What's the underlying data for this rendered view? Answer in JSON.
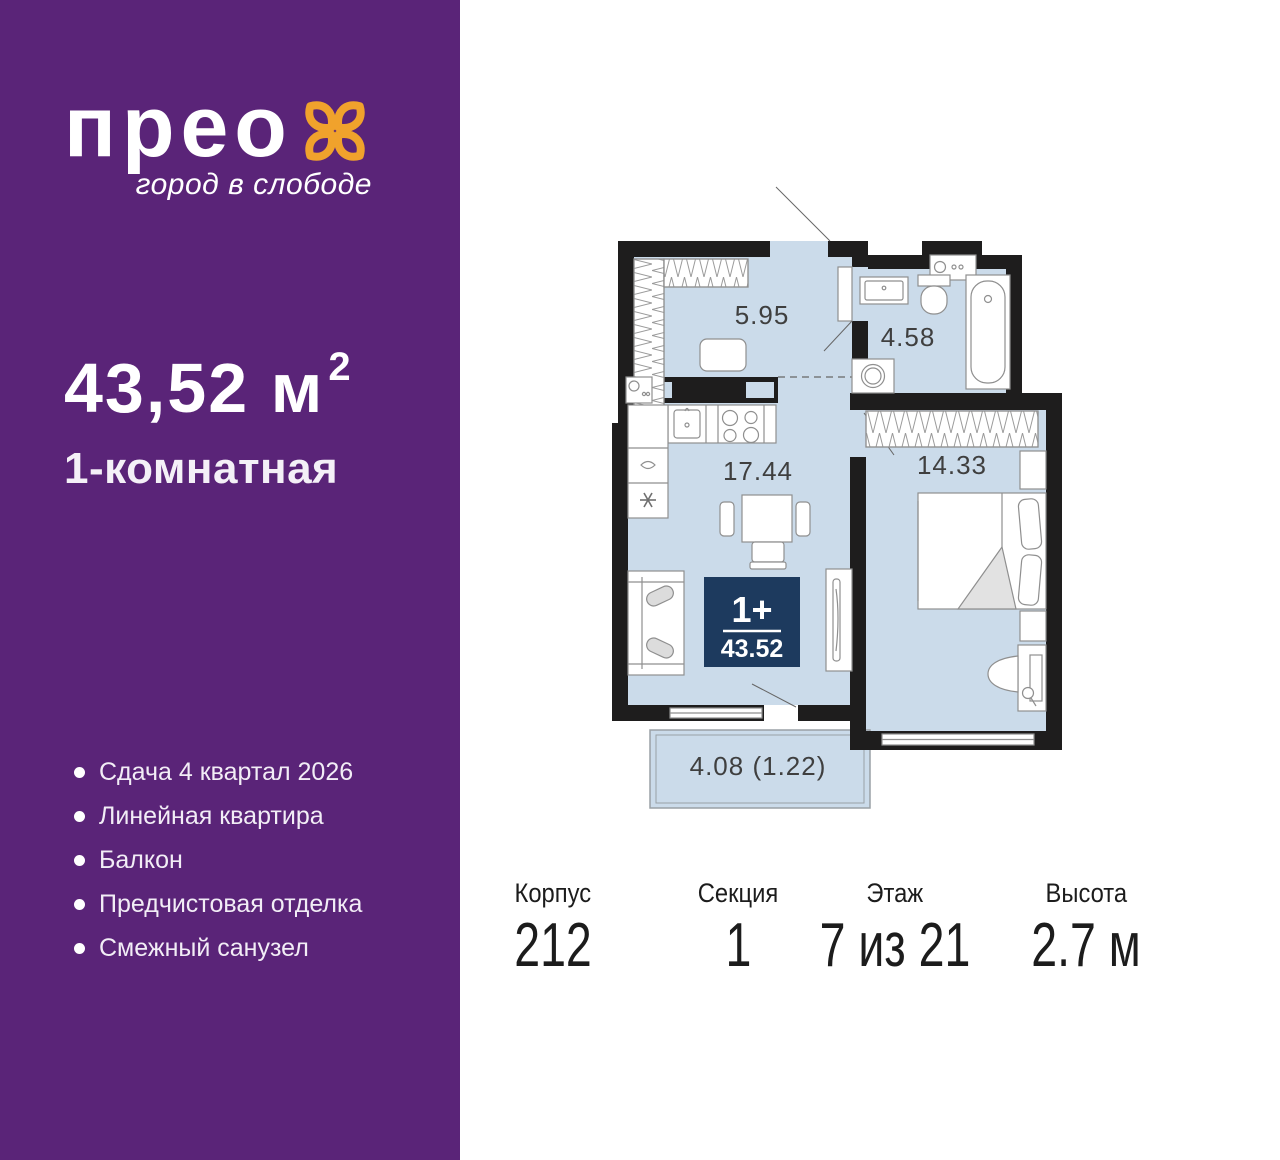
{
  "sidebar": {
    "logo_text": "прео",
    "logo_tagline": "город в слободе",
    "area_value": "43,52 м",
    "area_superscript": "2",
    "apartment_type": "1-комнатная",
    "features": [
      "Сдача 4 квартал 2026",
      "Линейная квартира",
      "Балкон",
      "Предчистовая отделка",
      "Смежный санузел"
    ],
    "colors": {
      "background": "#5a2478",
      "logo_accent": "#f0a22c"
    }
  },
  "floorplan": {
    "fill_color": "#cbdbea",
    "wall_color": "#1e1d1d",
    "rooms": [
      {
        "name": "hallway",
        "area": "5.95"
      },
      {
        "name": "bathroom",
        "area": "4.58"
      },
      {
        "name": "kitchen-living-room",
        "area": "17.44"
      },
      {
        "name": "bedroom",
        "area": "14.33"
      },
      {
        "name": "balcony",
        "area": "4.08 (1.22)"
      }
    ],
    "badge": {
      "rooms_label": "1+",
      "area": "43.52",
      "color": "#1d3a5e"
    }
  },
  "details": {
    "columns": [
      {
        "label": "Корпус",
        "value": "212"
      },
      {
        "label": "Секция",
        "value": "1"
      },
      {
        "label": "Этаж",
        "value": "7 из 21"
      },
      {
        "label": "Высота",
        "value": "2.7 м"
      }
    ]
  }
}
